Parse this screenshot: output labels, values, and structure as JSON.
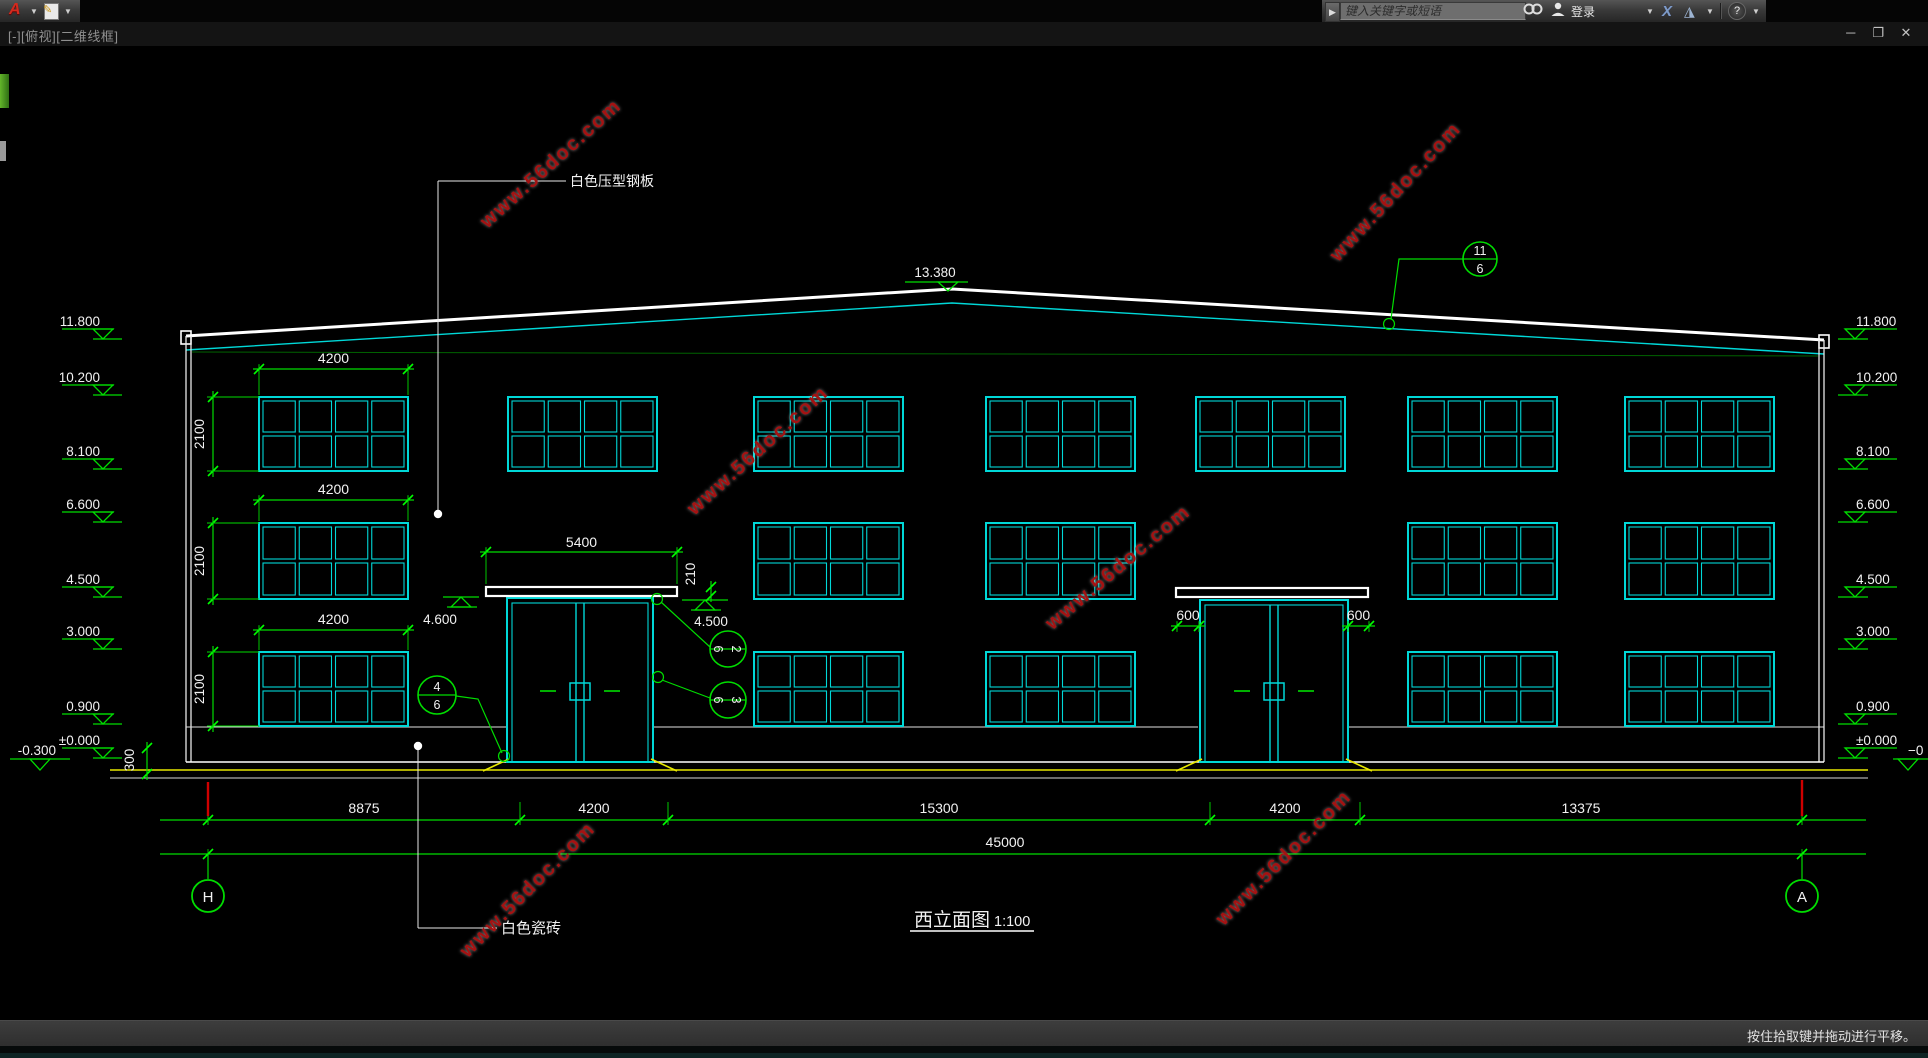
{
  "app": {
    "logo": "A",
    "viewport_label": "[-][俯视][二维线框]",
    "search_placeholder": "键入关键字或短语",
    "login_label": "登录",
    "statusbar_hint": "按住拾取键并拖动进行平移。",
    "window_controls": {
      "minimize": "─",
      "restore": "❐",
      "close": "✕"
    }
  },
  "drawing": {
    "title": "西立面图",
    "scale_label": "1:100",
    "watermark_text": "www.56doc.com",
    "colors": {
      "green": "#00dd00",
      "bright_green": "#00ff00",
      "cyan": "#00d8d8",
      "white": "#f2f2f2",
      "yellow": "#e8e800",
      "red_grid": "#cf0000",
      "watermark": "#a51212"
    },
    "labels": {
      "roof_material": "白色压型钢板",
      "wall_material": "白色瓷砖"
    },
    "ridge_marker": {
      "label": "13.380",
      "x": 935,
      "y": 282
    },
    "levels": [
      {
        "label": "11.800",
        "y": 329
      },
      {
        "label": "10.200",
        "y": 385
      },
      {
        "label": "8.100",
        "y": 459
      },
      {
        "label": "6.600",
        "y": 512
      },
      {
        "label": "4.500",
        "y": 587
      },
      {
        "label": "3.000",
        "y": 639
      },
      {
        "label": "0.900",
        "y": 714
      },
      {
        "label": "±0.000",
        "y": 748
      }
    ],
    "level_low_left": {
      "label": "-0.300",
      "y": 759
    },
    "level_low_right_fragment": {
      "label": "−0",
      "y": 759
    },
    "mid_markers": [
      {
        "label": "4.600",
        "x1": 443,
        "x2": 479,
        "y": 597,
        "tx": 440,
        "ty": 624
      },
      {
        "label": "4.500",
        "x1": 682,
        "x2": 728,
        "y": 600,
        "tx": 711,
        "ty": 626
      }
    ],
    "roof": {
      "left_x": 186,
      "left_y": 336,
      "ridge_x": 952,
      "ridge_y": 289,
      "right_x": 1824,
      "right_y": 340,
      "offset": 14
    },
    "walls": {
      "left": [
        186,
        191
      ],
      "right": [
        1819,
        1824
      ],
      "top_l": 336,
      "top_r": 340,
      "bottom": 762
    },
    "sill_segments": [
      [
        186,
        507
      ],
      [
        653,
        1198
      ],
      [
        1348,
        1824
      ]
    ],
    "sill_y": 727,
    "ground": {
      "white1_y": 762,
      "yellow_y": 770,
      "white2_y": 778,
      "x1": 110,
      "x2": 1868,
      "bx1": 186,
      "bx2": 1824
    },
    "windows": {
      "cols": [
        259,
        508,
        754,
        986,
        1196,
        1408,
        1625
      ],
      "w": 149,
      "rows": [
        {
          "y": 397,
          "h": 74,
          "cols": [
            0,
            1,
            2,
            3,
            4,
            5,
            6
          ]
        },
        {
          "y": 523,
          "h": 76,
          "cols": [
            0,
            2,
            3,
            5,
            6
          ]
        },
        {
          "y": 652,
          "h": 74,
          "cols": [
            0,
            2,
            3,
            5,
            6
          ]
        }
      ]
    },
    "doors": [
      {
        "x": 507,
        "w": 146,
        "top": 598,
        "bottom": 762,
        "handle_y": 683
      },
      {
        "x": 1200,
        "w": 148,
        "top": 600,
        "bottom": 762,
        "handle_y": 683
      }
    ],
    "canopies": [
      {
        "x": 486,
        "w": 191,
        "y": 587,
        "h": 9
      },
      {
        "x": 1176,
        "w": 192,
        "y": 588,
        "h": 9
      }
    ],
    "h_dims": [
      {
        "label": "5400",
        "x1": 486,
        "x2": 677,
        "y": 552,
        "ty": 547,
        "ext_to": 584
      },
      {
        "label": "600",
        "x1": 1177,
        "x2": 1199,
        "y": 626,
        "ty": 620,
        "ext_to": 632
      },
      {
        "label": "600",
        "x1": 1348,
        "x2": 1369,
        "y": 626,
        "ty": 620,
        "ext_to": 632
      },
      {
        "label": "4200",
        "x1": 259,
        "x2": 408,
        "y": 369,
        "ty": 363,
        "ext_to": 395
      },
      {
        "label": "4200",
        "x1": 259,
        "x2": 408,
        "y": 500,
        "ty": 494,
        "ext_to": 521
      },
      {
        "label": "4200",
        "x1": 259,
        "x2": 408,
        "y": 630,
        "ty": 624,
        "ext_to": 650
      }
    ],
    "v_dims": [
      {
        "label": "2100",
        "x": 213,
        "y1": 397,
        "y2": 471,
        "ext_x": 259
      },
      {
        "label": "2100",
        "x": 213,
        "y1": 523,
        "y2": 599,
        "ext_x": 259
      },
      {
        "label": "2100",
        "x": 213,
        "y1": 652,
        "y2": 726,
        "ext_x": 259
      },
      {
        "label": "210",
        "x": 711,
        "y1": 587,
        "y2": 596,
        "text_x": 695,
        "text_y": 574
      },
      {
        "label": "300",
        "x": 147,
        "y1": 748,
        "y2": 774,
        "text_x": 134,
        "text_y": 760
      }
    ],
    "bottom_dims": {
      "line1_y": 820,
      "line2_y": 854,
      "x1": 160,
      "x2": 1866,
      "boundaries": [
        208,
        520,
        668,
        1210,
        1360,
        1802
      ],
      "segment_labels": [
        "8875",
        "4200",
        "15300",
        "4200",
        "13375"
      ],
      "total_label": "45000",
      "total_tx": 1005,
      "total_ty": 847,
      "label_y": 813
    },
    "grid_bubbles": [
      {
        "label": "H",
        "cx": 208,
        "cy": 896
      },
      {
        "label": "A",
        "cx": 1802,
        "cy": 896
      }
    ],
    "detail_bubbles": [
      {
        "top": "11",
        "bottom": "6",
        "cx": 1480,
        "cy": 259,
        "r": 17,
        "rot": 0,
        "leader": [
          [
            1391,
            319
          ],
          [
            1399,
            259
          ],
          [
            1463,
            259
          ]
        ],
        "grip": [
          1389,
          324
        ]
      },
      {
        "top": "2",
        "bottom": "6",
        "cx": 728,
        "cy": 649,
        "r": 18,
        "rot": 90,
        "leader": [
          [
            661,
            602
          ],
          [
            710,
            647
          ]
        ],
        "grip": [
          657,
          599
        ]
      },
      {
        "top": "3",
        "bottom": "6",
        "cx": 728,
        "cy": 700,
        "r": 18,
        "rot": 90,
        "leader": [
          [
            662,
            680
          ],
          [
            710,
            698
          ]
        ],
        "grip": [
          658,
          677
        ]
      },
      {
        "top": "4",
        "bottom": "6",
        "cx": 437,
        "cy": 695,
        "r": 19,
        "rot": 0,
        "leader": [
          [
            456,
            696
          ],
          [
            478,
            699
          ],
          [
            502,
            753
          ]
        ],
        "grip": [
          504,
          756
        ]
      }
    ],
    "leader_labels": [
      {
        "key": "roof_material",
        "tx": 570,
        "ty": 186,
        "size": 14,
        "hline": [
          438,
          566,
          181
        ],
        "vline": [
          438,
          181,
          513
        ],
        "dot": [
          438,
          514
        ]
      },
      {
        "key": "wall_material",
        "tx": 501,
        "ty": 933,
        "size": 15,
        "hline": [
          418,
          497,
          928
        ],
        "vline": [
          418,
          746,
          928
        ],
        "dot": [
          418,
          746
        ]
      }
    ],
    "title_block": {
      "tx": 914,
      "ty": 926,
      "scale_tx": 994,
      "underline": [
        910,
        1034,
        931
      ]
    },
    "watermarks": [
      {
        "x": 555,
        "y": 168,
        "rot": -42
      },
      {
        "x": 1400,
        "y": 196,
        "rot": -47
      },
      {
        "x": 762,
        "y": 455,
        "rot": -42
      },
      {
        "x": 1122,
        "y": 572,
        "rot": -40
      },
      {
        "x": 532,
        "y": 894,
        "rot": -45
      },
      {
        "x": 1288,
        "y": 862,
        "rot": -45
      }
    ]
  }
}
